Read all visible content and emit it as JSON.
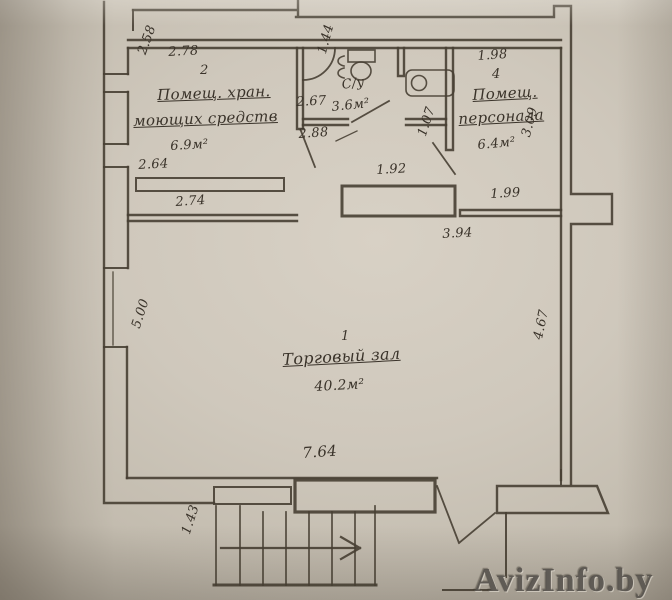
{
  "palette": {
    "paper": "#cfc8bc",
    "ink": "#473f33",
    "label_text": "#3a332a",
    "watermark_gray": "#58544e"
  },
  "plan": {
    "rooms": {
      "storage": {
        "number": "2",
        "name_line1": "Помещ. хран.",
        "name_line2": "моющих средств",
        "area": "6.9м²"
      },
      "wc": {
        "name": "С/у",
        "area": "3.6м²"
      },
      "staff": {
        "number": "4",
        "name_line1": "Помещ.",
        "name_line2": "персонала",
        "area": "6.4м²"
      },
      "hall": {
        "number": "1",
        "name": "Торговый зал",
        "area": "40.2м²"
      }
    },
    "dimensions": {
      "storage_width": "2.78",
      "storage_depth": "2.58",
      "storage_counter": "2.64",
      "storage_bottom": "2.74",
      "wc_width": "2.67",
      "wc_depth": "1.44",
      "wc_wall": "2.88",
      "counter_width": "1.92",
      "door_width": "1.07",
      "staff_width": "1.98",
      "staff_depth": "3.09",
      "staff_bottom": "1.99",
      "mid_width": "3.94",
      "hall_left": "5.00",
      "hall_right": "4.67",
      "hall_width": "7.64",
      "stairs_width": "1.43"
    }
  },
  "watermark": {
    "text": "AvizInfo.by"
  }
}
